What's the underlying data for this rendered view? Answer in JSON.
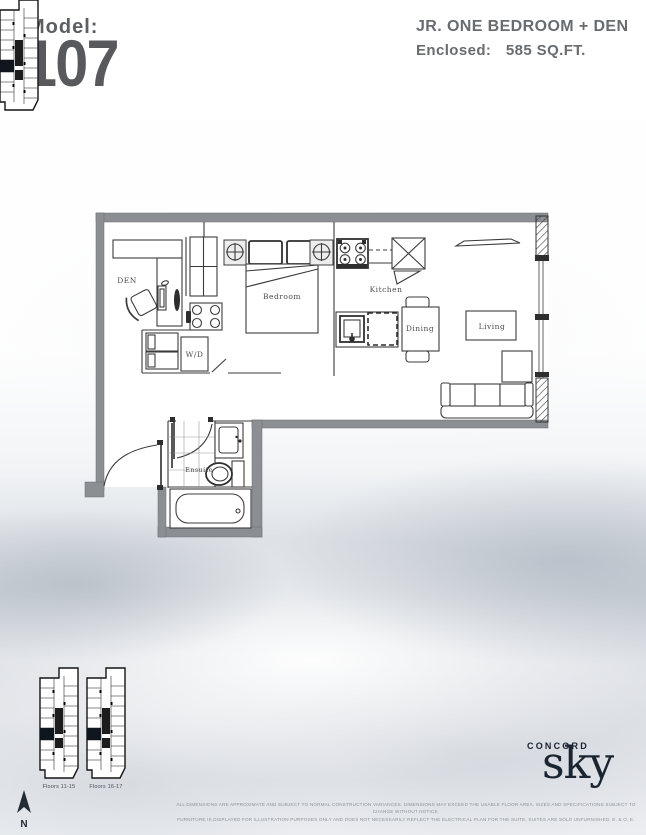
{
  "header": {
    "model_label": "Model:",
    "model_number": "107",
    "plan_type": "JR. ONE BEDROOM + DEN",
    "area_label": "Enclosed:",
    "area_value": "585 SQ.FT."
  },
  "floorplan": {
    "rooms": {
      "den": "DEN",
      "bedroom": "Bedroom",
      "kitchen": "Kitchen",
      "dining": "Dining",
      "living": "Living",
      "laundry": "W/D",
      "ensuite": "Ensuite"
    }
  },
  "keyplans": [
    {
      "label": "Floors 11-15"
    },
    {
      "label": "Floors 16-17"
    }
  ],
  "compass": {
    "north_label": "N"
  },
  "brand": {
    "name": "CONCORD",
    "product": "sky"
  },
  "disclaimer": {
    "line1": "ALL DIMENSIONS ARE APPROXIMATE AND SUBJECT TO NORMAL CONSTRUCTION VARIANCES. DIMENSIONS MAY EXCEED THE USABLE FLOOR AREA. SIZES AND SPECIFICATIONS SUBJECT TO CHANGE WITHOUT NOTICE.",
    "line2": "FURNITURE IS DISPLAYED FOR ILLUSTRATION PURPOSES ONLY AND DOES NOT NECESSARILY REFLECT THE ELECTRICAL PLAN FOR THE SUITE. SUITES ARE SOLD UNFURNISHED. E. & O. E."
  },
  "colors": {
    "brand_navy": "#1a2531",
    "heading_gray": "#57595c",
    "wall_gray": "#8b8e92"
  }
}
